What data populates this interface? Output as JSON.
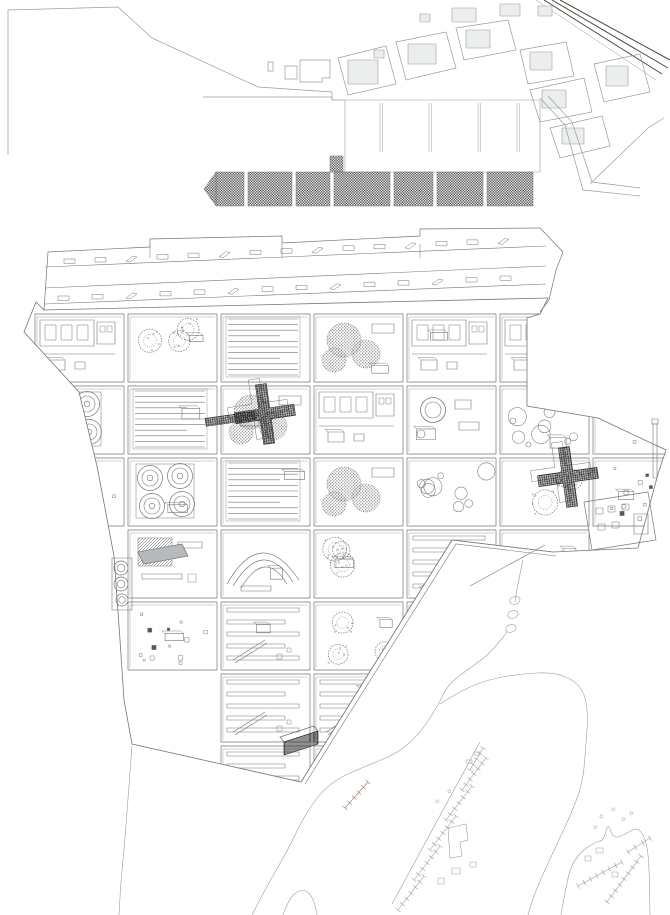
{
  "drawing": {
    "width": 670,
    "height": 915,
    "background": "#ffffff",
    "ink_light": "#989c9e",
    "ink": "#73777a",
    "ink_dark": "#2f2f2f",
    "ink_red": "#a5786a",
    "fill_gray": "#b7babc",
    "fill_soft": "#eceeee"
  },
  "context": {
    "border_line": [
      [
        8,
        10
      ],
      [
        8,
        155
      ]
    ],
    "coastline": [
      [
        8,
        10
      ],
      [
        118,
        7
      ],
      [
        152,
        38
      ],
      [
        258,
        87
      ],
      [
        332,
        92
      ],
      [
        332,
        100
      ],
      [
        345,
        100
      ]
    ],
    "coast_buildings": [
      [
        [
          268,
          62
        ],
        [
          273,
          62
        ],
        [
          273,
          71
        ],
        [
          268,
          71
        ]
      ],
      [
        [
          285,
          66
        ],
        [
          297,
          66
        ],
        [
          297,
          79
        ],
        [
          285,
          79
        ]
      ],
      [
        [
          300,
          60
        ],
        [
          330,
          60
        ],
        [
          330,
          78
        ],
        [
          322,
          78
        ],
        [
          322,
          82
        ],
        [
          300,
          82
        ]
      ]
    ],
    "rail_lines": [
      [
        [
          544,
          0
        ],
        [
          662,
          74
        ]
      ],
      [
        [
          552,
          0
        ],
        [
          668,
          68
        ]
      ],
      [
        [
          560,
          0
        ],
        [
          670,
          60
        ]
      ],
      [
        [
          536,
          0
        ],
        [
          656,
          80
        ]
      ]
    ],
    "top_strip_buildings": [
      [
        452,
        8,
        24,
        14
      ],
      [
        500,
        4,
        20,
        12
      ],
      [
        420,
        14,
        10,
        8
      ],
      [
        538,
        6,
        14,
        10
      ]
    ],
    "city_blocks": [
      {
        "poly": [
          [
            338,
            58
          ],
          [
            386,
            46
          ],
          [
            396,
            84
          ],
          [
            348,
            95
          ]
        ],
        "inner": [
          [
            348,
            60,
            30,
            24
          ],
          [
            374,
            50,
            10,
            8
          ]
        ]
      },
      {
        "poly": [
          [
            396,
            42
          ],
          [
            446,
            32
          ],
          [
            456,
            68
          ],
          [
            406,
            80
          ]
        ],
        "inner": [
          [
            408,
            44,
            28,
            20
          ]
        ]
      },
      {
        "poly": [
          [
            456,
            28
          ],
          [
            508,
            20
          ],
          [
            516,
            50
          ],
          [
            464,
            60
          ]
        ],
        "inner": [
          [
            466,
            30,
            24,
            18
          ]
        ]
      },
      {
        "poly": [
          [
            520,
            50
          ],
          [
            566,
            42
          ],
          [
            574,
            76
          ],
          [
            528,
            84
          ]
        ],
        "inner": [
          [
            530,
            52,
            22,
            18
          ]
        ]
      },
      {
        "poly": [
          [
            530,
            90
          ],
          [
            584,
            78
          ],
          [
            592,
            112
          ],
          [
            540,
            122
          ]
        ],
        "inner": [
          [
            542,
            90,
            24,
            18
          ]
        ]
      },
      {
        "poly": [
          [
            594,
            64
          ],
          [
            640,
            54
          ],
          [
            650,
            92
          ],
          [
            604,
            102
          ]
        ],
        "inner": [
          [
            606,
            66,
            22,
            20
          ]
        ]
      },
      {
        "poly": [
          [
            550,
            128
          ],
          [
            602,
            116
          ],
          [
            610,
            146
          ],
          [
            560,
            158
          ]
        ],
        "inner": [
          [
            562,
            128,
            22,
            16
          ]
        ]
      }
    ],
    "roads": [
      [
        [
          540,
          98
        ],
        [
          565,
          125
        ],
        [
          583,
          190
        ],
        [
          640,
          196
        ]
      ],
      [
        [
          548,
          96
        ],
        [
          572,
          122
        ],
        [
          592,
          182
        ],
        [
          640,
          188
        ]
      ],
      [
        [
          590,
          184
        ],
        [
          648,
          128
        ],
        [
          664,
          118
        ]
      ]
    ]
  },
  "quay": {
    "deck": [
      345,
      100,
      195,
      72
    ],
    "deck_lip": [
      [
        203,
        97
      ],
      [
        332,
        97
      ],
      [
        332,
        100
      ]
    ],
    "dividers_x": [
      380,
      429,
      478,
      517
    ],
    "divider_y": [
      103,
      152
    ],
    "checker_band": {
      "y": 172,
      "h": 34,
      "segments": [
        [
          216,
          28
        ],
        [
          248,
          44
        ],
        [
          296,
          34
        ],
        [
          334,
          56
        ],
        [
          394,
          39
        ],
        [
          437,
          46
        ],
        [
          487,
          46
        ]
      ],
      "tip": [
        [
          216,
          172
        ],
        [
          204,
          189
        ],
        [
          216,
          206
        ]
      ],
      "tab": [
        330,
        156,
        13,
        16
      ]
    }
  },
  "megastructure": {
    "outline": [
      [
        44,
        310
      ],
      [
        548,
        298
      ],
      [
        540,
        314
      ],
      [
        527,
        318
      ],
      [
        527,
        406
      ],
      [
        598,
        418
      ],
      [
        666,
        450
      ],
      [
        658,
        474
      ],
      [
        638,
        548
      ],
      [
        553,
        552
      ],
      [
        452,
        540
      ],
      [
        301,
        782
      ],
      [
        132,
        744
      ],
      [
        124,
        700
      ],
      [
        120,
        640
      ],
      [
        114,
        556
      ],
      [
        97,
        466
      ],
      [
        79,
        392
      ],
      [
        24,
        332
      ],
      [
        36,
        302
      ]
    ],
    "slabs": {
      "top_edge": [
        [
          48,
          252
        ],
        [
          150,
          247
        ],
        [
          150,
          239
        ],
        [
          282,
          236
        ],
        [
          282,
          243
        ],
        [
          420,
          236
        ],
        [
          420,
          229
        ],
        [
          540,
          228
        ]
      ],
      "right_cap": [
        [
          540,
          228
        ],
        [
          563,
          252
        ],
        [
          556,
          270
        ],
        [
          549,
          300
        ],
        [
          540,
          312
        ]
      ],
      "left_cap": [
        [
          48,
          252
        ],
        [
          44,
          310
        ]
      ],
      "levels": [
        [
          45,
          267,
          546,
          246
        ],
        [
          45,
          288,
          546,
          266
        ],
        [
          45,
          304,
          546,
          284
        ]
      ],
      "jog_ticks": [
        150,
        282,
        420
      ],
      "marks_rows": [
        {
          "y_left": 259,
          "y_right": 237,
          "x0": 64,
          "x1": 528,
          "step": 31
        },
        {
          "y_left": 296,
          "y_right": 275,
          "x0": 58,
          "x1": 522,
          "step": 34
        }
      ]
    },
    "grid": {
      "x0": 35,
      "y0": 314,
      "pitch": 93,
      "row_pitch": 72,
      "cell_w": 89,
      "cell_h": 68,
      "cells": [
        {
          "c": 0,
          "r": 0,
          "m": "windows"
        },
        {
          "c": 1,
          "r": 0,
          "m": "trees"
        },
        {
          "c": 2,
          "r": 0,
          "m": "slats"
        },
        {
          "c": 3,
          "r": 0,
          "m": "canopy"
        },
        {
          "c": 4,
          "r": 0,
          "m": "windows"
        },
        {
          "c": 5,
          "r": 0,
          "m": "windows"
        },
        {
          "c": 0,
          "r": 1,
          "m": "tanks"
        },
        {
          "c": 1,
          "r": 1,
          "m": "slats"
        },
        {
          "c": 2,
          "r": 1,
          "m": "canopy"
        },
        {
          "c": 3,
          "r": 1,
          "m": "windows"
        },
        {
          "c": 4,
          "r": 1,
          "m": "rings"
        },
        {
          "c": 5,
          "r": 1,
          "m": "circles"
        },
        {
          "c": 6,
          "r": 1,
          "m": "dots"
        },
        {
          "c": 0,
          "r": 2,
          "m": "dots"
        },
        {
          "c": 1,
          "r": 2,
          "m": "tanks"
        },
        {
          "c": 2,
          "r": 2,
          "m": "slats"
        },
        {
          "c": 3,
          "r": 2,
          "m": "canopy"
        },
        {
          "c": 4,
          "r": 2,
          "m": "circles"
        },
        {
          "c": 5,
          "r": 2,
          "m": "trees"
        },
        {
          "c": 6,
          "r": 2,
          "m": "dots"
        },
        {
          "c": 1,
          "r": 3,
          "m": "hatch"
        },
        {
          "c": 2,
          "r": 3,
          "m": "arcs"
        },
        {
          "c": 3,
          "r": 3,
          "m": "trees"
        },
        {
          "c": 4,
          "r": 3,
          "m": "bars"
        },
        {
          "c": 5,
          "r": 3,
          "m": "court"
        },
        {
          "c": 1,
          "r": 4,
          "m": "dots"
        },
        {
          "c": 2,
          "r": 4,
          "m": "bars"
        },
        {
          "c": 3,
          "r": 4,
          "m": "trees"
        },
        {
          "c": 4,
          "r": 4,
          "m": "bars"
        },
        {
          "c": 5,
          "r": 4,
          "m": "bars"
        },
        {
          "c": 2,
          "r": 5,
          "m": "bars"
        },
        {
          "c": 3,
          "r": 5,
          "m": "bars"
        },
        {
          "c": 4,
          "r": 5,
          "m": "bars"
        },
        {
          "c": 2,
          "r": 6,
          "m": "bars"
        },
        {
          "c": 3,
          "r": 6,
          "m": "bars"
        }
      ]
    },
    "crosses": [
      {
        "cx": 265,
        "cy": 414,
        "rot": -8,
        "arm": true
      },
      {
        "cx": 568,
        "cy": 477,
        "rot": -8,
        "arm": false
      }
    ],
    "gray_bar": [
      [
        138,
        552
      ],
      [
        182,
        544
      ],
      [
        188,
        556
      ],
      [
        144,
        564
      ]
    ],
    "striped_bar": {
      "front": [
        [
          284,
          742
        ],
        [
          318,
          731
        ],
        [
          318,
          744
        ],
        [
          284,
          755
        ]
      ],
      "top": [
        [
          284,
          742
        ],
        [
          318,
          731
        ],
        [
          314,
          726
        ],
        [
          280,
          737
        ]
      ]
    },
    "mast": [
      653,
      424,
      4,
      54
    ],
    "left_tanks": {
      "frame": [
        112,
        558,
        20,
        52
      ],
      "circles": [
        [
          121,
          568,
          7
        ],
        [
          121,
          584,
          7
        ],
        [
          122,
          600,
          6
        ]
      ]
    },
    "shed": {
      "poly": [
        [
          584,
          502
        ],
        [
          648,
          492
        ],
        [
          656,
          540
        ],
        [
          592,
          550
        ]
      ],
      "windows": [
        [
          596,
          508
        ],
        [
          608,
          506
        ],
        [
          622,
          504
        ],
        [
          598,
          524
        ],
        [
          612,
          522
        ]
      ],
      "door": [
        634,
        514,
        14,
        20
      ]
    },
    "edge_lines": [
      [
        [
          553,
          552
        ],
        [
          452,
          540
        ],
        [
          301,
          782
        ]
      ],
      [
        [
          556,
          556
        ],
        [
          456,
          544
        ],
        [
          305,
          784
        ]
      ],
      [
        [
          545,
          545
        ],
        [
          470,
          586
        ]
      ]
    ]
  },
  "waterfront": {
    "west_shore": [
      [
        132,
        746
      ],
      [
        128,
        800
      ],
      [
        124,
        850
      ],
      [
        121,
        880
      ],
      [
        119,
        915
      ]
    ],
    "channel_west": [
      [
        523,
        560
      ],
      [
        517,
        588
      ],
      [
        515,
        602
      ]
    ],
    "jetty_loops": [
      [
        511,
        598
      ],
      [
        509,
        612
      ],
      [
        507,
        626
      ]
    ],
    "channel_west2": [
      [
        507,
        632
      ],
      [
        492,
        652
      ],
      [
        470,
        668
      ],
      [
        448,
        684
      ],
      [
        438,
        706
      ],
      [
        418,
        736
      ],
      [
        396,
        754
      ],
      [
        366,
        766
      ],
      [
        330,
        782
      ],
      [
        306,
        812
      ],
      [
        288,
        850
      ],
      [
        268,
        884
      ],
      [
        252,
        915
      ]
    ],
    "hill": [
      [
        283,
        915
      ],
      [
        289,
        898
      ],
      [
        301,
        889
      ],
      [
        310,
        893
      ],
      [
        315,
        904
      ],
      [
        317,
        915
      ]
    ],
    "promontory": [
      [
        440,
        704
      ],
      [
        462,
        690
      ],
      [
        490,
        679
      ],
      [
        520,
        674
      ],
      [
        552,
        672
      ],
      [
        574,
        680
      ],
      [
        585,
        694
      ],
      [
        588,
        716
      ],
      [
        586,
        744
      ],
      [
        583,
        782
      ],
      [
        572,
        812
      ],
      [
        557,
        844
      ],
      [
        543,
        874
      ],
      [
        533,
        898
      ],
      [
        528,
        915
      ]
    ],
    "corner_land": [
      [
        561,
        915
      ],
      [
        567,
        880
      ],
      [
        573,
        862
      ],
      [
        583,
        850
      ],
      [
        596,
        842
      ],
      [
        604,
        840
      ],
      [
        608,
        822
      ],
      [
        613,
        839
      ],
      [
        626,
        834
      ],
      [
        637,
        827
      ],
      [
        645,
        837
      ],
      [
        649,
        858
      ],
      [
        650,
        915
      ]
    ],
    "piers": [
      {
        "a": [
          480,
          742
        ],
        "b": [
          392,
          904
        ],
        "t": 0
      },
      {
        "a": [
          470,
          770
        ],
        "b": [
          483,
          748
        ],
        "t": 5
      },
      {
        "a": [
          462,
          790
        ],
        "b": [
          486,
          758
        ],
        "t": 7
      },
      {
        "a": [
          446,
          820
        ],
        "b": [
          472,
          786
        ],
        "t": 7
      },
      {
        "a": [
          430,
          850
        ],
        "b": [
          456,
          816
        ],
        "t": 7
      },
      {
        "a": [
          414,
          880
        ],
        "b": [
          440,
          846
        ],
        "t": 7
      },
      {
        "a": [
          398,
          910
        ],
        "b": [
          424,
          876
        ],
        "t": 7
      },
      {
        "a": [
          345,
          808
        ],
        "b": [
          368,
          782
        ],
        "t": 6,
        "red": true
      },
      {
        "a": [
          578,
          886
        ],
        "b": [
          622,
          862
        ],
        "t": 8
      },
      {
        "a": [
          607,
          902
        ],
        "b": [
          641,
          856
        ],
        "t": 9
      },
      {
        "a": [
          628,
          852
        ],
        "b": [
          650,
          838
        ],
        "t": 4
      }
    ],
    "footprints": [
      [
        [
          448,
          828
        ],
        [
          466,
          824
        ],
        [
          468,
          840
        ],
        [
          460,
          842
        ],
        [
          462,
          856
        ],
        [
          450,
          858
        ]
      ]
    ],
    "small_rects": [
      [
        452,
        868,
        8,
        6
      ],
      [
        438,
        878,
        6,
        6
      ],
      [
        470,
        862,
        6,
        5
      ],
      [
        596,
        848,
        7,
        5
      ],
      [
        585,
        856,
        6,
        5
      ],
      [
        612,
        872,
        6,
        5
      ],
      [
        466,
        760,
        6,
        3
      ],
      [
        474,
        752,
        6,
        3
      ]
    ],
    "scatter": [
      [
        600,
        815
      ],
      [
        612,
        808
      ],
      [
        622,
        818
      ],
      [
        594,
        826
      ],
      [
        630,
        812
      ],
      [
        448,
        790
      ],
      [
        436,
        800
      ]
    ]
  }
}
